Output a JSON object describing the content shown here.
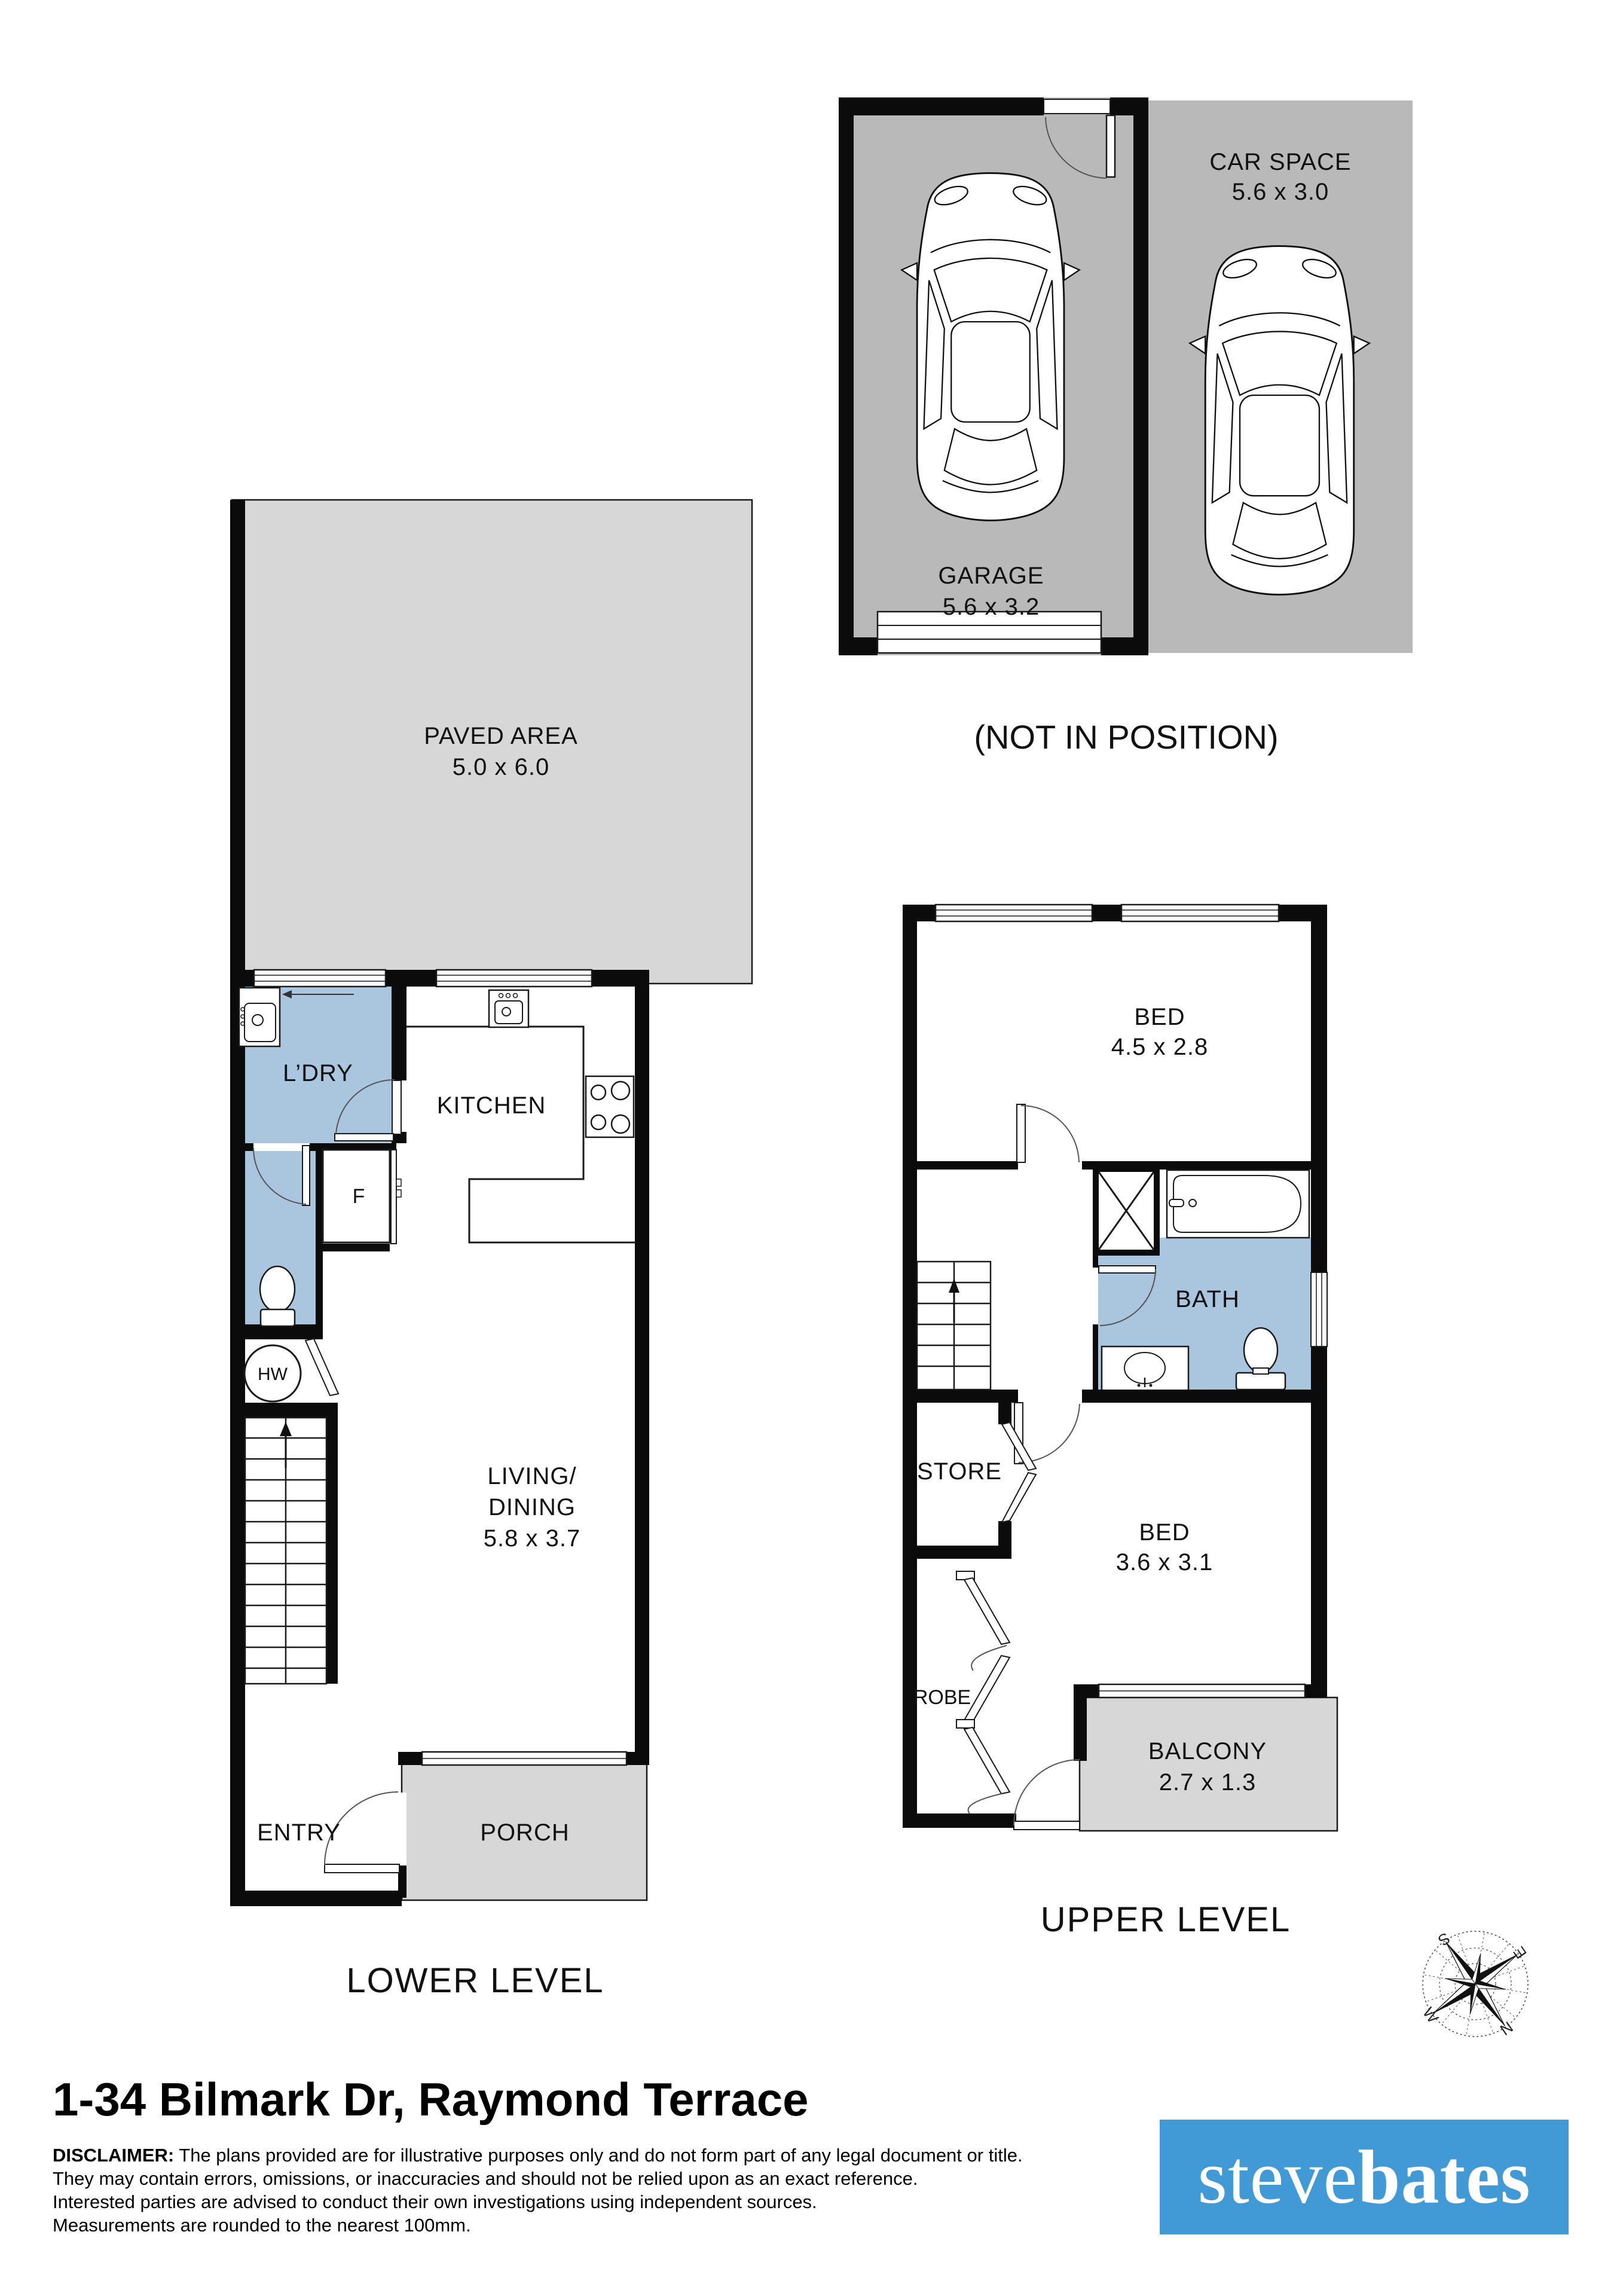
{
  "garage_block": {
    "garage": {
      "label": "GARAGE",
      "dims": "5.6 x 3.2"
    },
    "car_space": {
      "label": "CAR SPACE",
      "dims": "5.6 x 3.0"
    },
    "note": "(NOT IN POSITION)"
  },
  "lower": {
    "title": "LOWER LEVEL",
    "paved": {
      "label": "PAVED AREA",
      "dims": "5.0 x 6.0"
    },
    "laundry": {
      "label": "L’DRY"
    },
    "kitchen": {
      "label": "KITCHEN"
    },
    "fridge": {
      "label": "F"
    },
    "hot_water": {
      "label": "HW"
    },
    "living": {
      "line1": "LIVING/",
      "line2": "DINING",
      "dims": "5.8 x 3.7"
    },
    "entry": {
      "label": "ENTRY"
    },
    "porch": {
      "label": "PORCH"
    }
  },
  "upper": {
    "title": "UPPER LEVEL",
    "bed_main": {
      "label": "BED",
      "dims": "4.5 x 2.8"
    },
    "bath": {
      "label": "BATH"
    },
    "store": {
      "label": "STORE"
    },
    "bed_second": {
      "label": "BED",
      "dims": "3.6 x 3.1"
    },
    "robe": {
      "label": "ROBE"
    },
    "balcony": {
      "label": "BALCONY",
      "dims": "2.7 x 1.3"
    }
  },
  "compass": {
    "north": "N",
    "south": "S",
    "east": "E",
    "west": "W"
  },
  "footer": {
    "address": "1-34 Bilmark Dr, Raymond Terrace",
    "disclaimer_label": "DISCLAIMER:",
    "disclaimer_lines": [
      "The plans provided are for illustrative purposes only and do not form part of any legal document or title.",
      "They may contain errors, omissions, or inaccuracies and should not be relied upon as an exact reference.",
      "Interested parties are advised to conduct their own investigations using independent sources.",
      "Measurements are rounded to the nearest 100mm."
    ],
    "logo": {
      "part1": "steve",
      "part2": "bates"
    }
  },
  "colors": {
    "floor_gray": "#d7d7d7",
    "garage_gray": "#b9b9b9",
    "wet_area_blue": "#a9c6de",
    "wall_black": "#0b0b0b",
    "logo_blue": "#419ad6"
  }
}
